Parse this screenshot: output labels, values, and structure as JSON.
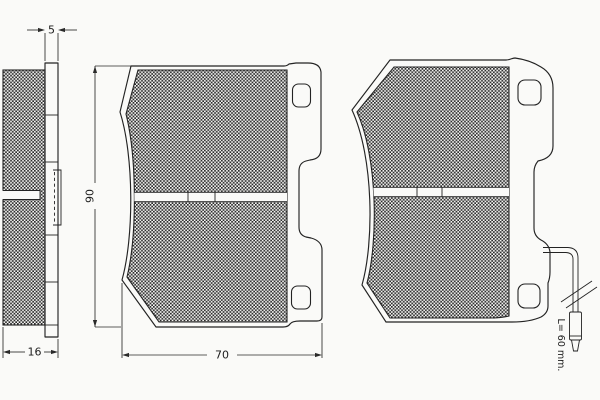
{
  "drawing": {
    "kind": "brake-pad-technical-drawing",
    "colors": {
      "background": "#fafaf8",
      "line": "#232323",
      "hatch": "#2b2b2b"
    },
    "dimensions": {
      "backplate_thickness": "5",
      "total_thickness": "16",
      "pad_height": "90",
      "pad_width": "70",
      "wear_indicator_length": "L= 60 mm."
    }
  }
}
